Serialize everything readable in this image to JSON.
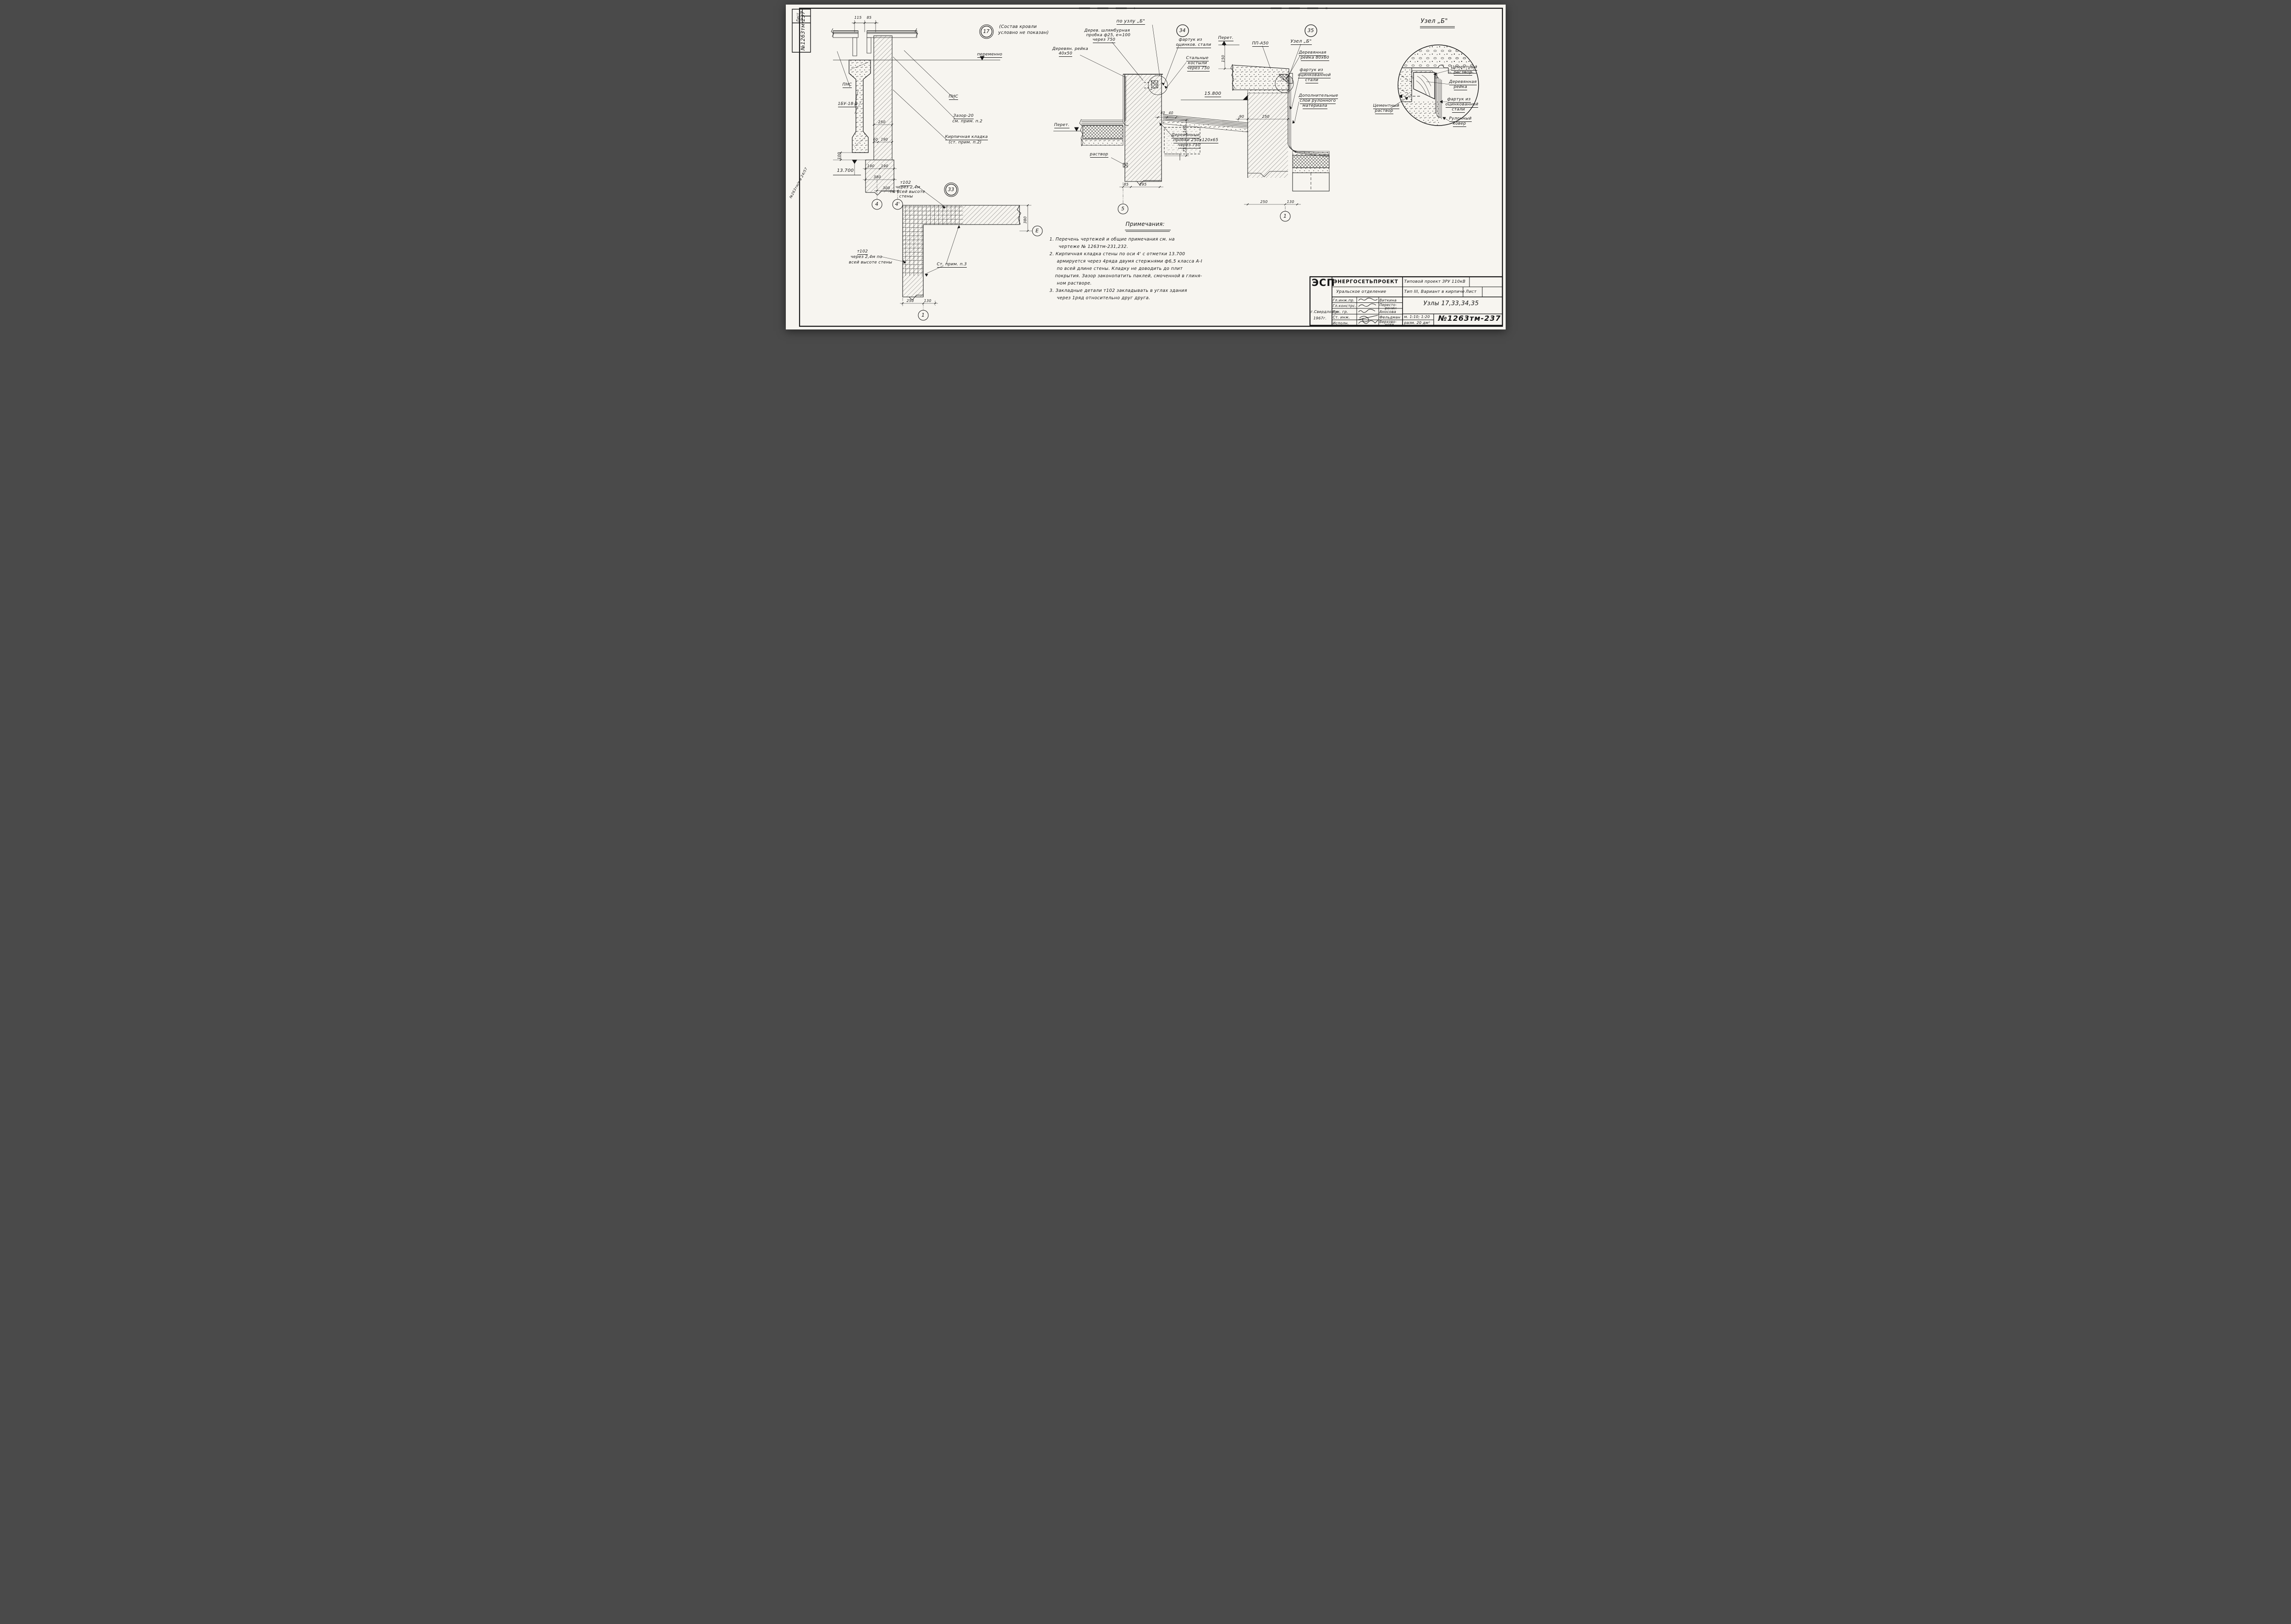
{
  "stamp": {
    "list": "Лист",
    "num": "№1263тм-237",
    "margin": "№263тм/в  а 24/57"
  },
  "d17": {
    "num": "17",
    "note1": "(Состав кровли",
    "note2": "условно не показан)",
    "d115": "115",
    "d85": "85",
    "pnsL": "ПНС",
    "pnsR": "ПНС",
    "perem": "переменно",
    "zazor1": "Зазор-20",
    "zazor2": "см. прим. п.2",
    "beam": "1БУ-18-2",
    "brick1": "Кирпичная кладка",
    "brick2": "(ст. прим. п.2)",
    "d250": "250",
    "d60": "60",
    "d190": "190",
    "d100": "100",
    "lvl": "13.700",
    "d190a": "190",
    "d190b": "190",
    "d380": "380",
    "d300": "300",
    "ax4": "4",
    "ax4p": "4'"
  },
  "d34": {
    "num": "34",
    "title": "по узлу „Б\"",
    "probka1": "Дерев. шлямбурная",
    "probka2": "пробка ф25, е=100",
    "probka3": "через 750",
    "reika1": "Деревян. рейка",
    "reika2": "40х50",
    "fartuk1": "фартук из",
    "fartuk2": "оцинков. стали",
    "kost1": "Стальные",
    "kost2": "костыли",
    "kost3": "через 750",
    "lvl": "15.800",
    "d140": "140",
    "d75": "75",
    "d40a": "40",
    "d40b": "40",
    "rastvor": "раствор",
    "d85": "85",
    "d295": "295",
    "ax5": "5",
    "der1": "Деревянные",
    "der2": "пробки 250х120х65",
    "der3": "через 750",
    "perem": "Перет."
  },
  "d35": {
    "num": "35",
    "perem": "Перет.",
    "d150": "150",
    "pp": "ПП-А50",
    "uzel": "Узел „Б\"",
    "reika1": "Деревянная",
    "reika2": "рейка 80х60",
    "fartuk1": "фартук из",
    "fartuk2": "оцинкованной",
    "fartuk3": "стали",
    "dop1": "Дополнительные",
    "dop2": "слои рулонного",
    "dop3": "материала",
    "d90": "90",
    "d250": "250",
    "d250b": "250",
    "d130": "130",
    "ax1": "1"
  },
  "uzelB": {
    "title": "Узел „Б\"",
    "cem1": "Цементный",
    "cem2": "раствор",
    "reika1": "Деревянная",
    "reika2": "рейка",
    "fartuk1": "фартук из",
    "fartuk2": "оцинкованной",
    "fartuk3": "стали",
    "rulon1": "Рулонный",
    "rulon2": "ковер",
    "cemL1": "Цементный",
    "cemL2": "раствор"
  },
  "d33": {
    "num": "33",
    "top1": "т102",
    "top2": "через 2,4м",
    "top3": "по всей высоте",
    "top4": "стены",
    "left1": "т102",
    "left2": "через 2,4м по",
    "left3": "всей высоте стены",
    "prim": "Ст. прим. п.3",
    "d250": "250",
    "d130": "130",
    "d380": "380",
    "ax1": "1",
    "axE": "Е"
  },
  "notes": {
    "title": "Примечания:",
    "l1": "1. Перечень чертежей и общие примечания см. на",
    "l2": "чертеже № 1263тм-231,232.",
    "l3": "2. Кирпичная кладка стены по оси 4' с отметки 13.700",
    "l4": "армируется через 4ряда двумя стержнями ф6,5 класса А-I",
    "l5": "по всей длине стены. Кладку не доводить до плит",
    "l6": "покрытия. Зазор законопатить паклей, смоченной в глиня-",
    "l7": "ном растворе.",
    "l8": "3. Закладные детали т102 закладывать в углах здания",
    "l9": "через 1ряд относительно друг друга."
  },
  "tb": {
    "logo": "ЭСП",
    "org": "ЭНЕРГОСЕТЬПРОЕКТ",
    "dept": "Уральское отделение",
    "proj1": "Типовой проект ЗРУ 110кВ",
    "proj2": "Тип III, Вариант в кирпиче",
    "list": "Лист",
    "r1": "Гл.инж.пр.",
    "n1": "Виткина",
    "r2": "Гл.констрс.",
    "n2a": "Пересто-",
    "n2b": "ронин",
    "r3": "Рук. гр.",
    "n3": "Аносова",
    "r4": "Ст. инж.",
    "n4": "Фельдман",
    "r5": "Исполн.",
    "n5a": "Верхово-",
    "n5b": "нова",
    "title": "Узлы 17,33,34,35",
    "scale": "м. 1:10; 1:20",
    "size": "разм. 20 дм²",
    "num": "№1263тм-237",
    "city": "г.Свердловск",
    "year": "1967г."
  }
}
